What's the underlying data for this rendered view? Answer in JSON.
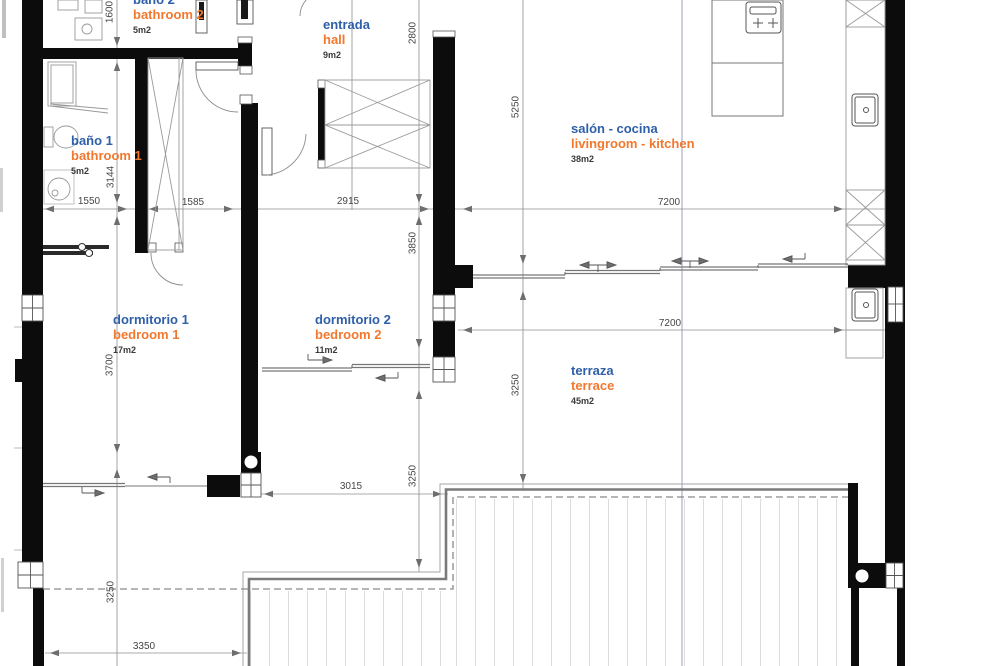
{
  "colors": {
    "room_name_es": "#2e5fa9",
    "room_name_en": "#f2782e",
    "wall": "#0c0c0c",
    "dimension_text": "#454545",
    "dimension_line": "#8f8f8f",
    "guide_line": "#a9b1c6"
  },
  "rooms": [
    {
      "id": "bathroom2",
      "name_es": "baño 2",
      "name_en": "bathroom 2",
      "area": "5m2"
    },
    {
      "id": "entrance",
      "name_es": "entrada",
      "name_en": "hall",
      "area": "9m2"
    },
    {
      "id": "bathroom1",
      "name_es": "baño 1",
      "name_en": "bathroom 1",
      "area": "5m2"
    },
    {
      "id": "livingroom",
      "name_es": "salón - cocina",
      "name_en": "livingroom - kitchen",
      "area": "38m2"
    },
    {
      "id": "bedroom1",
      "name_es": "dormitorio 1",
      "name_en": "bedroom 1",
      "area": "17m2"
    },
    {
      "id": "bedroom2",
      "name_es": "dormitorio 2",
      "name_en": "bedroom 2",
      "area": "11m2"
    },
    {
      "id": "terrace",
      "name_es": "terraza",
      "name_en": "terrace",
      "area": "45m2"
    }
  ],
  "dimensions": [
    {
      "value": "1550",
      "orientation": "h"
    },
    {
      "value": "1585",
      "orientation": "h"
    },
    {
      "value": "2915",
      "orientation": "h"
    },
    {
      "value": "7200",
      "orientation": "h"
    },
    {
      "value": "7200",
      "orientation": "h"
    },
    {
      "value": "3015",
      "orientation": "h"
    },
    {
      "value": "3350",
      "orientation": "h"
    },
    {
      "value": "1600",
      "orientation": "v"
    },
    {
      "value": "3144",
      "orientation": "v"
    },
    {
      "value": "3700",
      "orientation": "v"
    },
    {
      "value": "3250",
      "orientation": "v"
    },
    {
      "value": "2800",
      "orientation": "v"
    },
    {
      "value": "3850",
      "orientation": "v"
    },
    {
      "value": "3250",
      "orientation": "v"
    },
    {
      "value": "5250",
      "orientation": "v"
    },
    {
      "value": "3250",
      "orientation": "v"
    }
  ]
}
